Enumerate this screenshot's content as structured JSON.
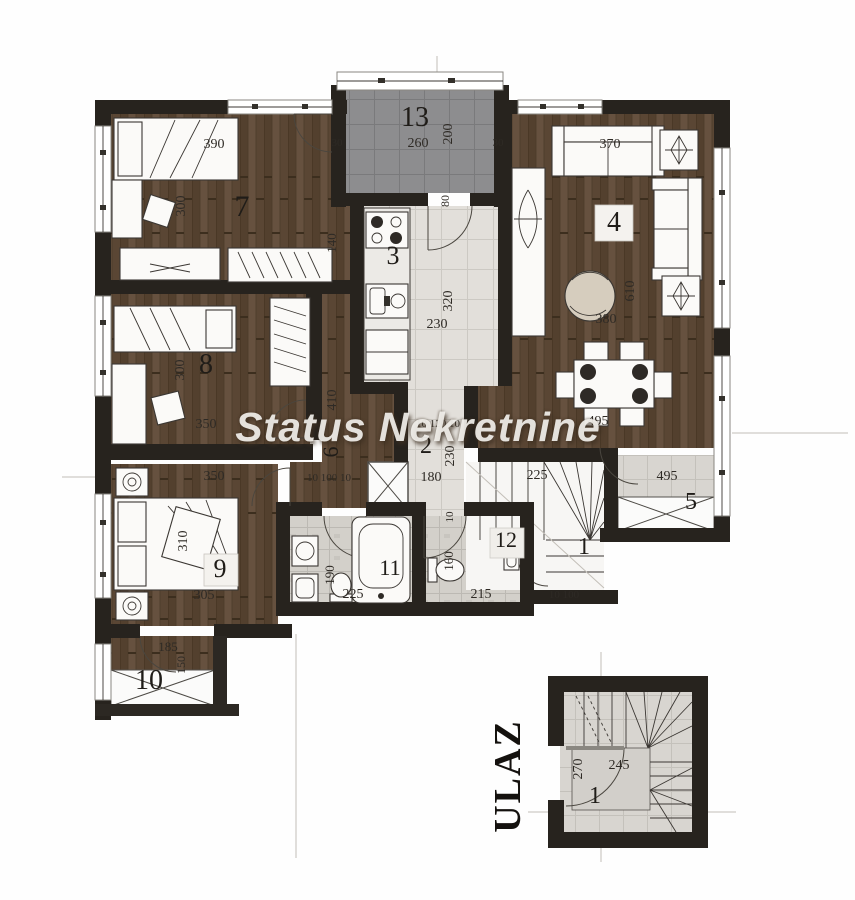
{
  "watermark": {
    "text": "Status Nekretnine"
  },
  "entrance": {
    "label": "ULAZ"
  },
  "colors": {
    "wall": "#27231e",
    "wood": "#5d4937",
    "wood_dark": "#53402e",
    "wood_light": "#66513f",
    "tile_kitchen": "#e2dfda",
    "tile_bath": "#d3d0ca",
    "tile_stairs": "#d8d5d0",
    "terrace": "#8d8d8f",
    "paper": "#ffffff",
    "label_ink": "#2e2a25",
    "watermark_color": "#f2f0eb"
  },
  "plan": {
    "room_labels": [
      {
        "text": "7",
        "x": 242,
        "y": 216,
        "size": 30
      },
      {
        "text": "13",
        "x": 415,
        "y": 126,
        "size": 28
      },
      {
        "text": "3",
        "x": 393,
        "y": 264,
        "size": 26
      },
      {
        "text": "4",
        "x": 614,
        "y": 231,
        "size": 28
      },
      {
        "text": "8",
        "x": 206,
        "y": 373,
        "size": 28
      },
      {
        "text": "6",
        "x": 338,
        "y": 452,
        "size": 22,
        "rot": -90
      },
      {
        "text": "2",
        "x": 426,
        "y": 453,
        "size": 24
      },
      {
        "text": "9",
        "x": 220,
        "y": 577,
        "size": 26
      },
      {
        "text": "11",
        "x": 390,
        "y": 575,
        "size": 22
      },
      {
        "text": "12",
        "x": 506,
        "y": 547,
        "size": 22
      },
      {
        "text": "1",
        "x": 584,
        "y": 554,
        "size": 24
      },
      {
        "text": "5",
        "x": 691,
        "y": 509,
        "size": 24
      },
      {
        "text": "10",
        "x": 149,
        "y": 689,
        "size": 28
      },
      {
        "text": "1",
        "x": 595,
        "y": 803,
        "size": 24
      }
    ],
    "dim_labels": [
      {
        "text": "390",
        "x": 214,
        "y": 148
      },
      {
        "text": "30",
        "x": 337,
        "y": 146,
        "size": 11
      },
      {
        "text": "260",
        "x": 418,
        "y": 147
      },
      {
        "text": "200",
        "x": 452,
        "y": 134,
        "rot": -90
      },
      {
        "text": "30",
        "x": 498,
        "y": 146,
        "size": 11
      },
      {
        "text": "370",
        "x": 610,
        "y": 148
      },
      {
        "text": "300",
        "x": 185,
        "y": 206,
        "rot": -90
      },
      {
        "text": "140",
        "x": 336,
        "y": 243,
        "rot": -90,
        "size": 13
      },
      {
        "text": "80",
        "x": 449,
        "y": 201,
        "rot": -90,
        "size": 12
      },
      {
        "text": "610",
        "x": 634,
        "y": 291,
        "rot": -90
      },
      {
        "text": "320",
        "x": 452,
        "y": 301,
        "rot": -90
      },
      {
        "text": "230",
        "x": 437,
        "y": 328
      },
      {
        "text": "380",
        "x": 606,
        "y": 323
      },
      {
        "text": "300",
        "x": 184,
        "y": 370,
        "rot": -90
      },
      {
        "text": "410",
        "x": 336,
        "y": 400,
        "rot": -90
      },
      {
        "text": "350",
        "x": 206,
        "y": 428
      },
      {
        "text": "10 120 10",
        "x": 438,
        "y": 427,
        "size": 11
      },
      {
        "text": "230",
        "x": 454,
        "y": 456,
        "rot": -90
      },
      {
        "text": "180",
        "x": 431,
        "y": 481
      },
      {
        "text": "10 100 10",
        "x": 329,
        "y": 481,
        "size": 11
      },
      {
        "text": "350",
        "x": 214,
        "y": 480
      },
      {
        "text": "225",
        "x": 537,
        "y": 479
      },
      {
        "text": "495",
        "x": 598,
        "y": 425
      },
      {
        "text": "495",
        "x": 667,
        "y": 480
      },
      {
        "text": "310",
        "x": 187,
        "y": 541,
        "rot": -90
      },
      {
        "text": "305",
        "x": 204,
        "y": 599
      },
      {
        "text": "190",
        "x": 334,
        "y": 575,
        "rot": -90,
        "size": 13
      },
      {
        "text": "225",
        "x": 353,
        "y": 598
      },
      {
        "text": "10",
        "x": 453,
        "y": 517,
        "rot": -90,
        "size": 11
      },
      {
        "text": "160",
        "x": 453,
        "y": 561,
        "rot": -90,
        "size": 13
      },
      {
        "text": "215",
        "x": 481,
        "y": 598
      },
      {
        "text": "10 100",
        "x": 564,
        "y": 598,
        "size": 11
      },
      {
        "text": "185",
        "x": 168,
        "y": 651,
        "size": 13
      },
      {
        "text": "150",
        "x": 185,
        "y": 665,
        "rot": -90,
        "size": 12
      },
      {
        "text": "245",
        "x": 619,
        "y": 769
      },
      {
        "text": "270",
        "x": 582,
        "y": 769,
        "rot": -90
      }
    ]
  }
}
